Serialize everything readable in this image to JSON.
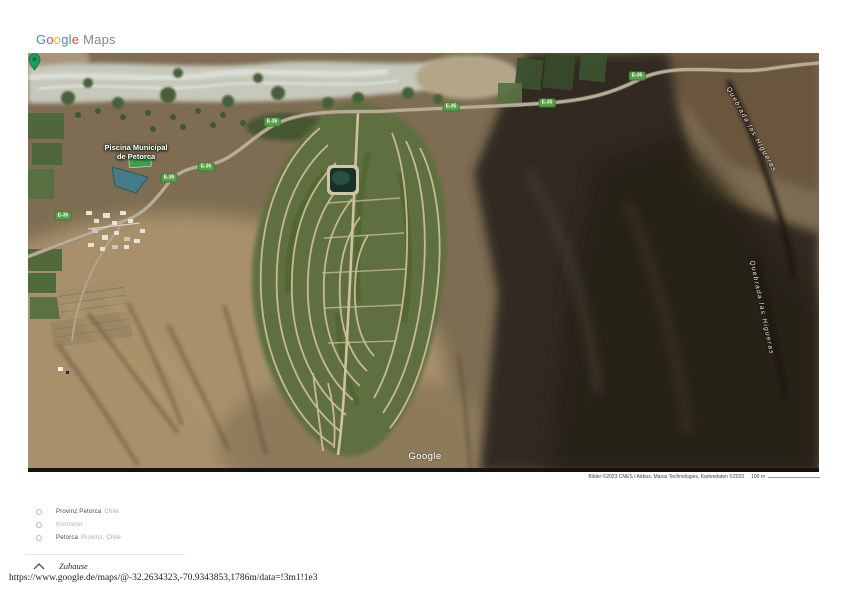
{
  "logo": {
    "letters": [
      {
        "char": "G",
        "color": "#4285F4"
      },
      {
        "char": "o",
        "color": "#EA4335"
      },
      {
        "char": "o",
        "color": "#FBBC05"
      },
      {
        "char": "g",
        "color": "#4285F4"
      },
      {
        "char": "l",
        "color": "#34A853"
      },
      {
        "char": "e",
        "color": "#EA4335"
      }
    ],
    "suffix": "Maps",
    "suffix_color": "#80868b"
  },
  "map": {
    "type": "satellite",
    "watermark": "Google",
    "place_label": {
      "line1": "Piscina Municipal",
      "line2": "de Petorca"
    },
    "pin_color": "#17a05e",
    "shield_color": "#58a14b",
    "route_shields": [
      {
        "label": "E-35"
      },
      {
        "label": "E-35"
      },
      {
        "label": "E-35"
      },
      {
        "label": "E-35"
      },
      {
        "label": "E-35"
      },
      {
        "label": "E-35"
      },
      {
        "label": "E-35"
      }
    ],
    "terrain_labels": [
      {
        "text": "Quebrada las Higueras"
      },
      {
        "text": "Quebrada las Higueras"
      }
    ],
    "attribution": "Bilder ©2023 CNES / Airbus, Maxar Technologies, Kartendaten ©2023",
    "scale_text": "100 m"
  },
  "suggestions": {
    "items": [
      {
        "primary": "Provinz Petorca",
        "secondary": "Chile"
      },
      {
        "primary": "Kilometer",
        "secondary": ""
      },
      {
        "primary": "Petorca",
        "secondary": "Provinz, Chile"
      }
    ]
  },
  "footer": {
    "home_label": "Zuhause",
    "url": "https://www.google.de/maps/@-32.2634323,-70.9343853,1786m/data=!3m1!1e3"
  }
}
